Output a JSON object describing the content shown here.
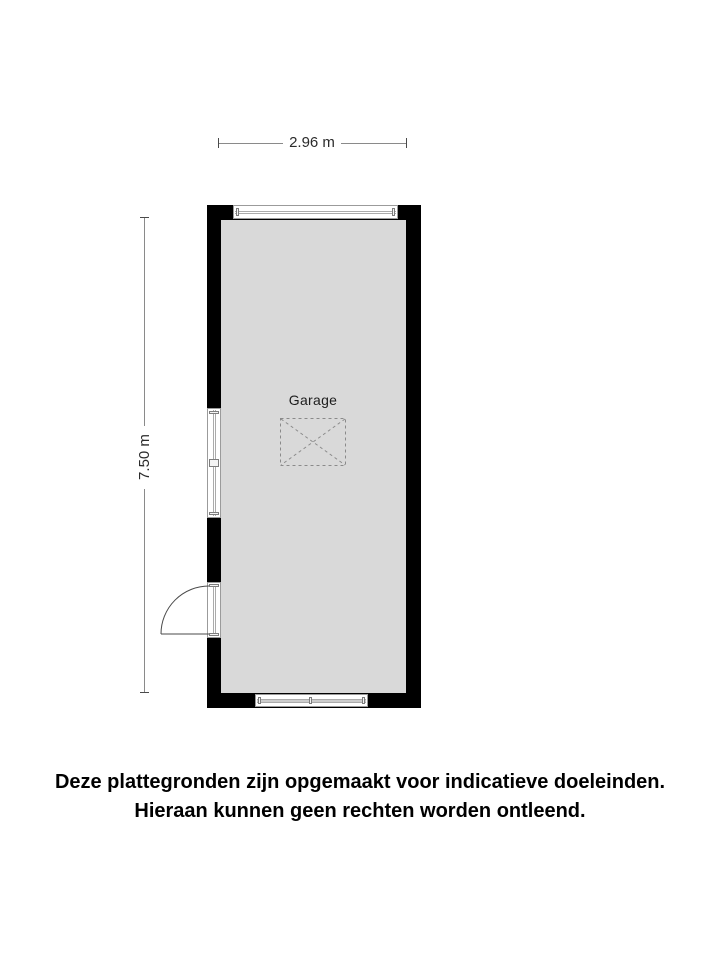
{
  "floorplan": {
    "room": {
      "label": "Garage"
    },
    "dimensions": {
      "width": {
        "label": "2.96 m"
      },
      "height": {
        "label": "7.50 m"
      }
    }
  },
  "disclaimer": {
    "line1": "Deze plattegronden zijn opgemaakt voor indicatieve doeleinden.",
    "line2": "Hieraan kunnen geen rechten worden ontleend."
  },
  "colors": {
    "wall": "#000000",
    "floor": "#d9d9d9",
    "window-frame": "#9b9b9b",
    "glazing": "#ababab",
    "window-band": "#cccccc",
    "dashed": "#8a8a8a",
    "dimension-line": "#8a8a8a",
    "dimension-tick": "#4a4a4a",
    "dimension-text": "#2b2b2b",
    "label-text": "#1d1d1d",
    "door-stroke": "#4a4a4a",
    "text": "#000000",
    "bg": "#ffffff"
  }
}
